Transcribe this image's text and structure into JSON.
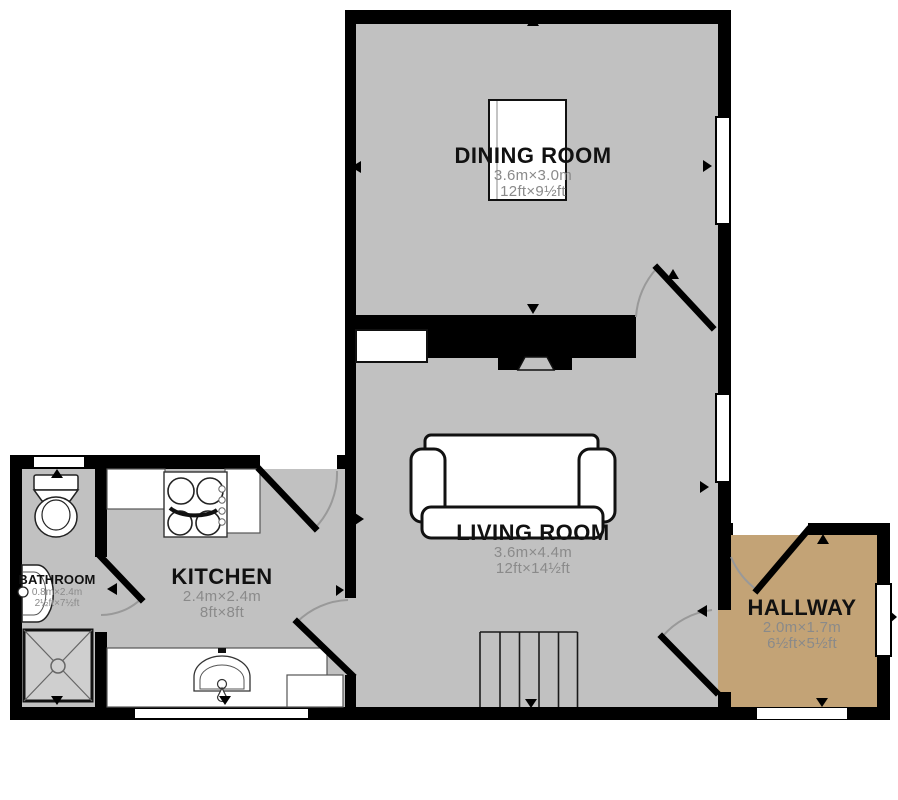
{
  "colors": {
    "wall": "#000000",
    "floor": "#c1c1c1",
    "hallway_floor": "#c3a376",
    "arc": "#999999",
    "room_text": "#111111",
    "dim_text": "#8a8a8a",
    "shower_fill": "#cfcfcf"
  },
  "rooms": [
    {
      "name": "DINING ROOM",
      "metric": "3.6m×3.0m",
      "imperial": "12ft×9½ft"
    },
    {
      "name": "LIVING ROOM",
      "metric": "3.6m×4.4m",
      "imperial": "12ft×14½ft"
    },
    {
      "name": "KITCHEN",
      "metric": "2.4m×2.4m",
      "imperial": "8ft×8ft"
    },
    {
      "name": "BATHROOM",
      "metric": "0.8m×2.4m",
      "imperial": "2½ft×7½ft"
    },
    {
      "name": "HALLWAY",
      "metric": "2.0m×1.7m",
      "imperial": "6½ft×5½ft"
    }
  ]
}
